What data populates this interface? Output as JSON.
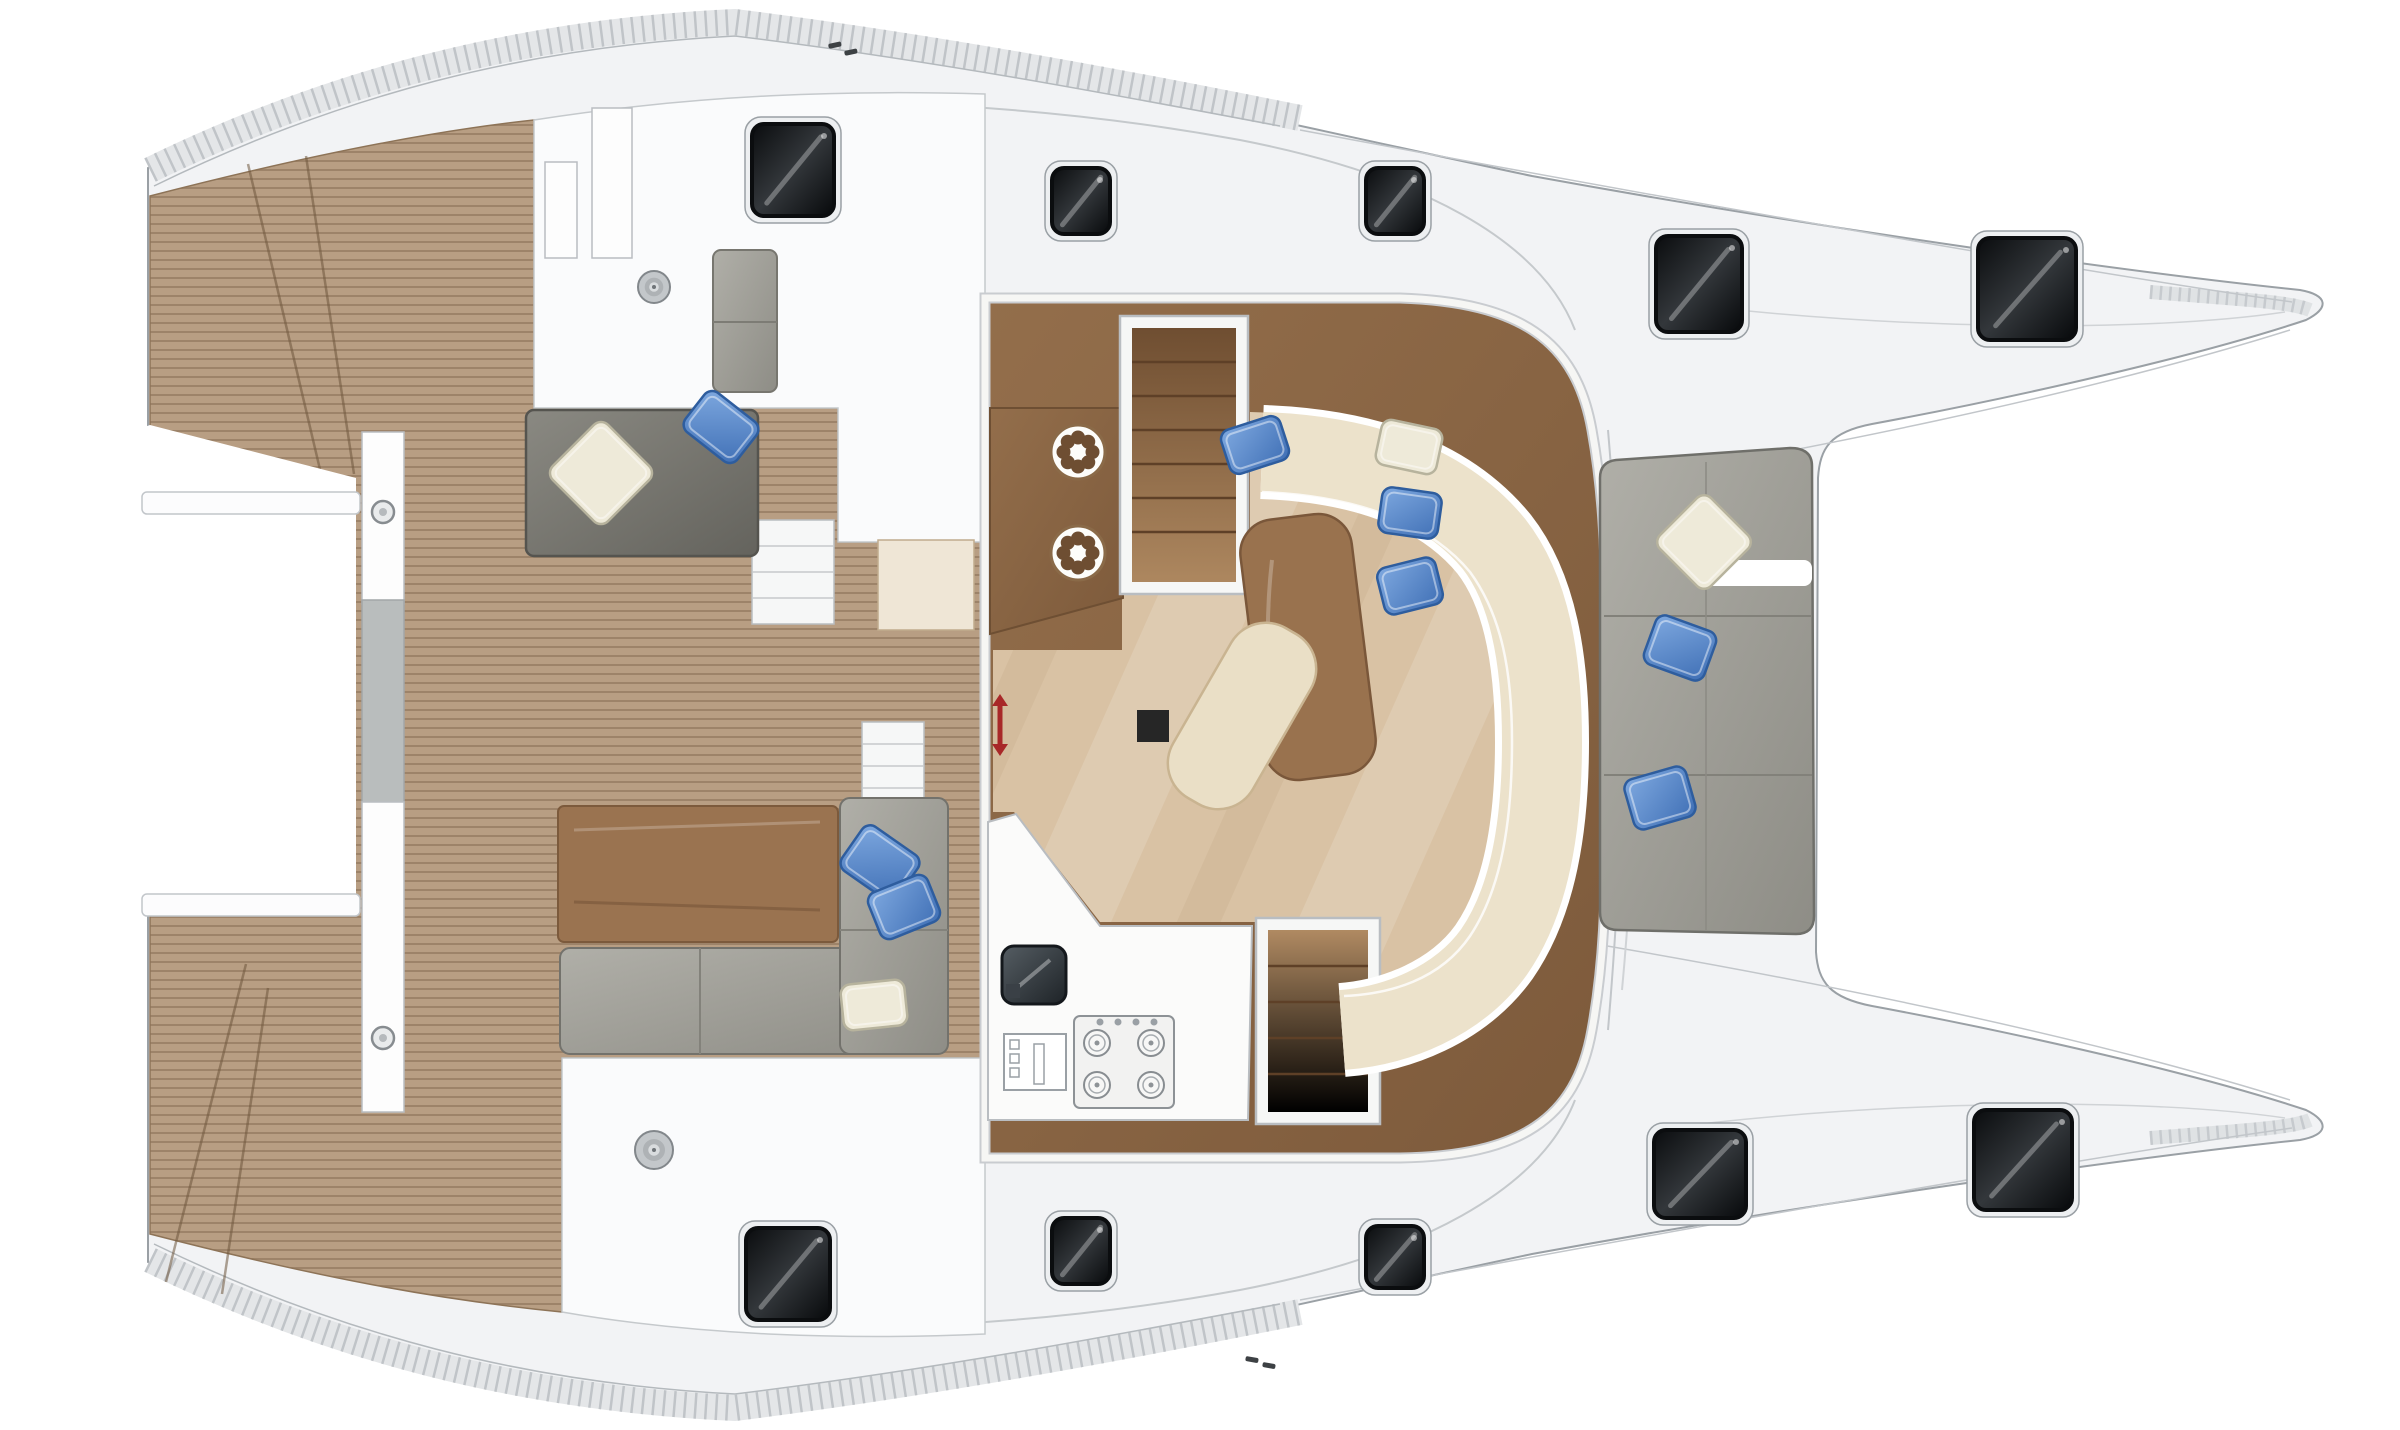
{
  "meta": {
    "label": "catamaran-deck-and-saloon-floor-plan"
  },
  "palette": {
    "page": "#ffffff",
    "hull": "#f2f3f5",
    "hull_line": "#9aa0a5",
    "soft_line": "#c5c9cc",
    "deck_white": "#fafbfc",
    "teak": "#b89e83",
    "teak_stripe": "rgba(118,94,70,0.42)",
    "wood_dark": "#8f6b49",
    "wood_mid": "#99724e",
    "floor_light": "#d9c2a4",
    "sofa_cream": "#ece2cb",
    "cushion_gray": "#9b9a93",
    "sofa_dark_gray": "#7e7d77",
    "pillow_blue": "#5b8fd4",
    "pillow_white": "#eeead9",
    "hatch_glass": "#101214",
    "arrow_red": "#a82828"
  },
  "hatches": [
    {
      "x": 752,
      "y": 124,
      "w": 82,
      "h": 92
    },
    {
      "x": 1052,
      "y": 168,
      "w": 58,
      "h": 66
    },
    {
      "x": 1366,
      "y": 168,
      "w": 58,
      "h": 66
    },
    {
      "x": 1656,
      "y": 236,
      "w": 86,
      "h": 96
    },
    {
      "x": 1978,
      "y": 238,
      "w": 98,
      "h": 102
    },
    {
      "x": 746,
      "y": 1228,
      "w": 84,
      "h": 92
    },
    {
      "x": 1052,
      "y": 1218,
      "w": 58,
      "h": 66
    },
    {
      "x": 1366,
      "y": 1226,
      "w": 58,
      "h": 62
    },
    {
      "x": 1654,
      "y": 1130,
      "w": 92,
      "h": 88
    },
    {
      "x": 1974,
      "y": 1110,
      "w": 98,
      "h": 100
    }
  ],
  "winches": [
    {
      "cx": 654,
      "cy": 287,
      "r": 16
    },
    {
      "cx": 654,
      "cy": 1150,
      "r": 19
    }
  ],
  "fridges": [
    {
      "cx": 1078,
      "cy": 452
    },
    {
      "cx": 1078,
      "cy": 553
    }
  ],
  "bolts": [
    {
      "cx": 383,
      "cy": 512
    },
    {
      "cx": 383,
      "cy": 1038
    }
  ],
  "burners": [
    {
      "cx": 1097,
      "cy": 1043
    },
    {
      "cx": 1151,
      "cy": 1043
    },
    {
      "cx": 1097,
      "cy": 1085
    },
    {
      "cx": 1151,
      "cy": 1085
    }
  ],
  "knobs": [
    {
      "cx": 1100,
      "cy": 1022
    },
    {
      "cx": 1118,
      "cy": 1022
    },
    {
      "cx": 1136,
      "cy": 1022
    },
    {
      "cx": 1154,
      "cy": 1022
    }
  ],
  "cleats": [
    {
      "x": 828,
      "y": 44,
      "rot": -12
    },
    {
      "x": 844,
      "y": 51,
      "rot": -12
    },
    {
      "x": 1246,
      "y": 1356,
      "rot": 10
    },
    {
      "x": 1263,
      "y": 1362,
      "rot": 10
    }
  ],
  "pillows": [
    {
      "type": "white",
      "x": 562,
      "y": 434,
      "w": 78,
      "h": 78,
      "rot": 45
    },
    {
      "type": "blue",
      "x": 688,
      "y": 402,
      "w": 66,
      "h": 50,
      "rot": 38
    },
    {
      "type": "blue",
      "x": 1224,
      "y": 422,
      "w": 62,
      "h": 46,
      "rot": -18
    },
    {
      "type": "white",
      "x": 1378,
      "y": 424,
      "w": 62,
      "h": 46,
      "rot": 12
    },
    {
      "type": "blue",
      "x": 1380,
      "y": 490,
      "w": 60,
      "h": 46,
      "rot": 8
    },
    {
      "type": "blue",
      "x": 1380,
      "y": 562,
      "w": 60,
      "h": 48,
      "rot": -14
    },
    {
      "type": "white",
      "x": 1668,
      "y": 506,
      "w": 72,
      "h": 72,
      "rot": 45
    },
    {
      "type": "blue",
      "x": 1648,
      "y": 622,
      "w": 64,
      "h": 52,
      "rot": 20
    },
    {
      "type": "blue",
      "x": 1628,
      "y": 772,
      "w": 64,
      "h": 52,
      "rot": -16
    },
    {
      "type": "blue",
      "x": 846,
      "y": 836,
      "w": 68,
      "h": 54,
      "rot": 35
    },
    {
      "type": "blue",
      "x": 872,
      "y": 882,
      "w": 64,
      "h": 50,
      "rot": -22
    },
    {
      "type": "cream",
      "x": 842,
      "y": 982,
      "w": 64,
      "h": 46,
      "rot": -6
    }
  ],
  "red_arrow": {
    "x": 1000,
    "y1": 694,
    "y2": 756
  }
}
